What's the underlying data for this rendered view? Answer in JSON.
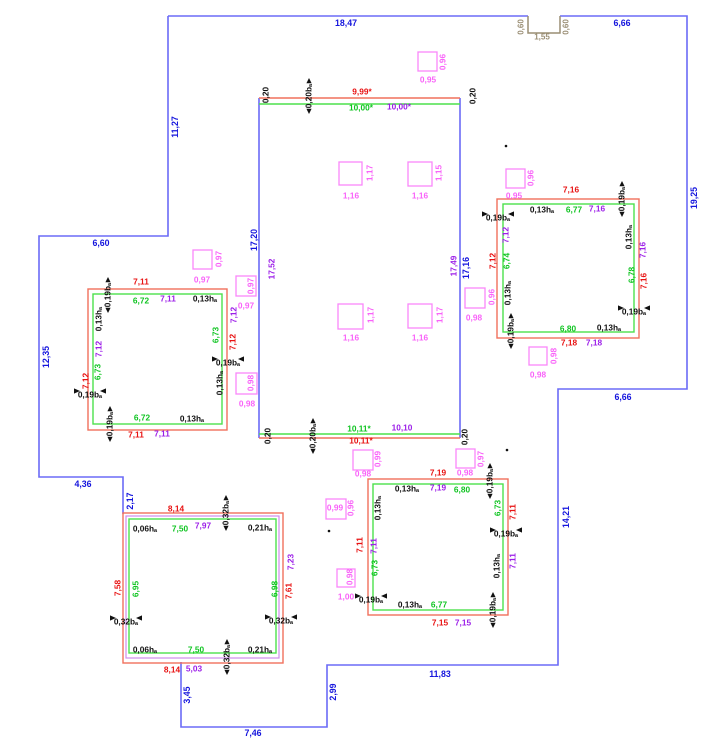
{
  "canvas": {
    "w": 724,
    "h": 745,
    "bg": "#ffffff"
  },
  "palette": {
    "blue": "#1515dd",
    "red": "#e81212",
    "green": "#0fc421",
    "purple": "#9c1fe8",
    "magenta": "#f963f9",
    "black": "#111111",
    "tan": "#9a8e74",
    "lblue": "#6b6bf7",
    "lred": "#f1705c",
    "lgreen": "#4ce04c",
    "lpurple": "#cf8cec",
    "lmagenta": "#fa87fa"
  },
  "polylines": [
    {
      "name": "building-outline-top",
      "c": "lblue",
      "sw": 1.6,
      "pts": [
        [
          168,
          16
        ],
        [
          528,
          16
        ]
      ]
    },
    {
      "name": "building-outline-right",
      "c": "lblue",
      "sw": 1.6,
      "pts": [
        [
          560,
          16
        ],
        [
          687,
          16
        ],
        [
          687,
          389
        ],
        [
          558,
          389
        ],
        [
          558,
          665
        ],
        [
          327,
          665
        ],
        [
          327,
          727
        ],
        [
          181,
          727
        ],
        [
          181,
          662
        ]
      ]
    },
    {
      "name": "building-outline-left",
      "c": "lblue",
      "sw": 1.6,
      "pts": [
        [
          123,
          514
        ],
        [
          123,
          477
        ],
        [
          39,
          477
        ],
        [
          39,
          236
        ],
        [
          168,
          236
        ],
        [
          168,
          16
        ]
      ]
    },
    {
      "name": "roof-notch",
      "c": "tan",
      "sw": 1.5,
      "pts": [
        [
          528,
          16
        ],
        [
          528,
          33
        ],
        [
          560,
          33
        ],
        [
          560,
          16
        ]
      ]
    },
    {
      "name": "hall-wall-left",
      "c": "lblue",
      "sw": 1.6,
      "pts": [
        [
          259,
          98
        ],
        [
          259,
          438
        ]
      ]
    },
    {
      "name": "hall-wall-right",
      "c": "lblue",
      "sw": 1.6,
      "pts": [
        [
          460,
          98
        ],
        [
          460,
          438
        ]
      ]
    },
    {
      "name": "hall-top-outer",
      "c": "lred",
      "sw": 1.4,
      "pts": [
        [
          259,
          98
        ],
        [
          460,
          98
        ]
      ]
    },
    {
      "name": "hall-top-inner",
      "c": "lgreen",
      "sw": 1.4,
      "pts": [
        [
          259,
          104
        ],
        [
          460,
          104
        ]
      ]
    },
    {
      "name": "hall-bottom-inner",
      "c": "lgreen",
      "sw": 1.4,
      "pts": [
        [
          259,
          434
        ],
        [
          460,
          434
        ]
      ]
    },
    {
      "name": "hall-bottom-outer",
      "c": "lred",
      "sw": 1.4,
      "pts": [
        [
          259,
          438
        ],
        [
          460,
          438
        ]
      ]
    }
  ],
  "rects": [
    {
      "name": "room-ne-outer",
      "c": "lred",
      "sw": 1.4,
      "x": 497,
      "y": 199,
      "w": 142,
      "h": 139
    },
    {
      "name": "room-ne-inner",
      "c": "lgreen",
      "sw": 1.4,
      "x": 503,
      "y": 204,
      "w": 131,
      "h": 128
    },
    {
      "name": "room-w-outer",
      "c": "lred",
      "sw": 1.4,
      "x": 88,
      "y": 289,
      "w": 139,
      "h": 141
    },
    {
      "name": "room-w-inner",
      "c": "lgreen",
      "sw": 1.4,
      "x": 93,
      "y": 294,
      "w": 129,
      "h": 130
    },
    {
      "name": "room-sw-outer",
      "c": "lred",
      "sw": 1.4,
      "x": 123,
      "y": 513,
      "w": 160,
      "h": 150
    },
    {
      "name": "room-sw-mid",
      "c": "lpurple",
      "sw": 1.2,
      "x": 126,
      "y": 516,
      "w": 153,
      "h": 142
    },
    {
      "name": "room-sw-inner",
      "c": "lgreen",
      "sw": 1.4,
      "x": 129,
      "y": 519,
      "w": 147,
      "h": 134
    },
    {
      "name": "room-s-outer",
      "c": "lred",
      "sw": 1.4,
      "x": 368,
      "y": 479,
      "w": 140,
      "h": 136
    },
    {
      "name": "room-s-inner",
      "c": "lgreen",
      "sw": 1.4,
      "x": 373,
      "y": 484,
      "w": 130,
      "h": 126
    }
  ],
  "windows": [
    {
      "x": 418,
      "y": 52,
      "s": 19
    },
    {
      "x": 339,
      "y": 162,
      "s": 23
    },
    {
      "x": 408,
      "y": 162,
      "s": 24
    },
    {
      "x": 338,
      "y": 304,
      "s": 25
    },
    {
      "x": 408,
      "y": 304,
      "s": 24
    },
    {
      "x": 193,
      "y": 250,
      "s": 19
    },
    {
      "x": 236,
      "y": 276,
      "s": 20
    },
    {
      "x": 236,
      "y": 373,
      "s": 21
    },
    {
      "x": 465,
      "y": 288,
      "s": 20
    },
    {
      "x": 506,
      "y": 169,
      "s": 19
    },
    {
      "x": 529,
      "y": 347,
      "s": 18
    },
    {
      "x": 353,
      "y": 450,
      "s": 20
    },
    {
      "x": 456,
      "y": 449,
      "s": 19
    },
    {
      "x": 326,
      "y": 499,
      "s": 20
    },
    {
      "x": 337,
      "y": 569,
      "s": 18
    }
  ],
  "dots": [
    [
      506,
      146
    ],
    [
      507,
      450
    ],
    [
      329,
      531
    ]
  ],
  "labels": [
    [
      "18,47",
      346,
      23,
      "blue",
      0,
      ""
    ],
    [
      "6,66",
      622,
      23,
      "blue",
      0,
      ""
    ],
    [
      "19,25",
      694,
      198,
      "blue",
      -90,
      ""
    ],
    [
      "6,66",
      623,
      397,
      "blue",
      0,
      ""
    ],
    [
      "14,21",
      566,
      517,
      "blue",
      -90,
      ""
    ],
    [
      "11,83",
      440,
      674,
      "blue",
      0,
      ""
    ],
    [
      "2,99",
      333,
      692,
      "blue",
      -90,
      ""
    ],
    [
      "7,46",
      253,
      733,
      "blue",
      0,
      ""
    ],
    [
      "3,45",
      187,
      695,
      "blue",
      -90,
      ""
    ],
    [
      "2,17",
      130,
      501,
      "blue",
      -90,
      ""
    ],
    [
      "4,36",
      83,
      484,
      "blue",
      0,
      ""
    ],
    [
      "12,35",
      46,
      357,
      "blue",
      -90,
      ""
    ],
    [
      "6,60",
      101,
      243,
      "blue",
      0,
      ""
    ],
    [
      "11,27",
      175,
      127,
      "blue",
      -90,
      ""
    ],
    [
      "17,20",
      254,
      240,
      "blue",
      -90,
      ""
    ],
    [
      "17,16",
      466,
      268,
      "blue",
      -90,
      ""
    ],
    [
      "0,60",
      521,
      27,
      "tan",
      -90,
      ""
    ],
    [
      "1,55",
      542,
      37,
      "tan",
      0,
      ""
    ],
    [
      "0,60",
      566,
      27,
      "tan",
      -90,
      ""
    ],
    [
      "9,99*",
      362,
      92,
      "red",
      0,
      ""
    ],
    [
      "10,11*",
      361,
      441,
      "red",
      0,
      ""
    ],
    [
      "7,16",
      571,
      190,
      "red",
      0,
      ""
    ],
    [
      "7,12",
      493,
      261,
      "red",
      -90,
      ""
    ],
    [
      "7,16",
      644,
      281,
      "red",
      -90,
      ""
    ],
    [
      "7,18",
      569,
      343,
      "red",
      0,
      ""
    ],
    [
      "7,11",
      141,
      282,
      "red",
      0,
      ""
    ],
    [
      "7,12",
      86,
      381,
      "red",
      -90,
      ""
    ],
    [
      "7,12",
      233,
      342,
      "red",
      -90,
      ""
    ],
    [
      "7,11",
      136,
      435,
      "red",
      0,
      ""
    ],
    [
      "8,14",
      176,
      509,
      "red",
      0,
      ""
    ],
    [
      "7,58",
      118,
      588,
      "red",
      -90,
      ""
    ],
    [
      "7,61",
      289,
      591,
      "red",
      -90,
      ""
    ],
    [
      "8,14",
      172,
      670,
      "red",
      0,
      ""
    ],
    [
      "7,19",
      438,
      473,
      "red",
      0,
      ""
    ],
    [
      "7,11",
      360,
      545,
      "red",
      -90,
      ""
    ],
    [
      "7,11",
      513,
      512,
      "red",
      -90,
      ""
    ],
    [
      "7,15",
      440,
      623,
      "red",
      0,
      ""
    ],
    [
      "10,00*",
      361,
      108,
      "green",
      0,
      ""
    ],
    [
      "10,11*",
      359,
      429,
      "green",
      0,
      ""
    ],
    [
      "6,77",
      574,
      210,
      "green",
      0,
      ""
    ],
    [
      "6,74",
      507,
      261,
      "green",
      -90,
      ""
    ],
    [
      "6,78",
      632,
      275,
      "green",
      -90,
      ""
    ],
    [
      "6,80",
      568,
      329,
      "green",
      0,
      ""
    ],
    [
      "6,72",
      141,
      301,
      "green",
      0,
      ""
    ],
    [
      "6,73",
      98,
      372,
      "green",
      -90,
      ""
    ],
    [
      "6,73",
      216,
      335,
      "green",
      -90,
      ""
    ],
    [
      "6,72",
      142,
      418,
      "green",
      0,
      ""
    ],
    [
      "7,50",
      180,
      529,
      "green",
      0,
      ""
    ],
    [
      "6,95",
      136,
      589,
      "green",
      -90,
      ""
    ],
    [
      "6,98",
      275,
      589,
      "green",
      -90,
      ""
    ],
    [
      "7,50",
      196,
      650,
      "green",
      0,
      ""
    ],
    [
      "6,80",
      462,
      490,
      "green",
      0,
      ""
    ],
    [
      "6,73",
      375,
      568,
      "green",
      -90,
      ""
    ],
    [
      "6,73",
      498,
      508,
      "green",
      -90,
      ""
    ],
    [
      "6,77",
      439,
      605,
      "green",
      0,
      ""
    ],
    [
      "10,00*",
      399,
      107,
      "purple",
      0,
      ""
    ],
    [
      "10,10",
      402,
      428,
      "purple",
      0,
      ""
    ],
    [
      "17,52",
      272,
      269,
      "purple",
      -90,
      ""
    ],
    [
      "17,49",
      454,
      266,
      "purple",
      -90,
      ""
    ],
    [
      "7,16",
      597,
      209,
      "purple",
      0,
      ""
    ],
    [
      "7,12",
      506,
      235,
      "purple",
      -90,
      ""
    ],
    [
      "7,16",
      643,
      250,
      "purple",
      -90,
      ""
    ],
    [
      "7,18",
      594,
      343,
      "purple",
      0,
      ""
    ],
    [
      "7,11",
      168,
      299,
      "purple",
      0,
      ""
    ],
    [
      "7,12",
      99,
      349,
      "purple",
      -90,
      ""
    ],
    [
      "7,12",
      234,
      315,
      "purple",
      -90,
      ""
    ],
    [
      "7,11",
      162,
      434,
      "purple",
      0,
      ""
    ],
    [
      "7,97",
      203,
      526,
      "purple",
      0,
      ""
    ],
    [
      "7,23",
      291,
      562,
      "purple",
      -90,
      ""
    ],
    [
      "5,03",
      194,
      669,
      "purple",
      0,
      ""
    ],
    [
      "7,19",
      438,
      488,
      "purple",
      0,
      ""
    ],
    [
      "7,11",
      374,
      546,
      "purple",
      -90,
      ""
    ],
    [
      "7,11",
      513,
      561,
      "purple",
      -90,
      ""
    ],
    [
      "7,15",
      463,
      623,
      "purple",
      0,
      ""
    ],
    [
      "0,20",
      266,
      95,
      "black",
      -90,
      ""
    ],
    [
      "0,20bₐ",
      309,
      96,
      "black",
      -90,
      "v"
    ],
    [
      "0,20",
      473,
      96,
      "black",
      -90,
      ""
    ],
    [
      "0,20",
      268,
      436,
      "black",
      -90,
      ""
    ],
    [
      "0,20bₐ",
      313,
      436,
      "black",
      -90,
      "v"
    ],
    [
      "0,20",
      465,
      437,
      "black",
      -90,
      ""
    ],
    [
      "0,13hₐ",
      542,
      210,
      "black",
      0,
      ""
    ],
    [
      "0,19bₐ",
      622,
      199,
      "black",
      -90,
      "v"
    ],
    [
      "0,19bₐ",
      498,
      218,
      "black",
      0,
      "h"
    ],
    [
      "0,13hₐ",
      508,
      293,
      "black",
      -90,
      ""
    ],
    [
      "0,13hₐ",
      629,
      237,
      "black",
      -90,
      ""
    ],
    [
      "0,19bₐ",
      634,
      312,
      "black",
      0,
      "h"
    ],
    [
      "0,19bₐ",
      511,
      331,
      "black",
      -90,
      "v"
    ],
    [
      "0,13hₐ",
      609,
      328,
      "black",
      0,
      ""
    ],
    [
      "0,19bₐ",
      108,
      295,
      "black",
      -90,
      "v"
    ],
    [
      "0,13hₐ",
      205,
      299,
      "black",
      0,
      ""
    ],
    [
      "0,13hₐ",
      99,
      319,
      "black",
      -90,
      ""
    ],
    [
      "0,19bₐ",
      90,
      395,
      "black",
      0,
      "h"
    ],
    [
      "0,19bₐ",
      228,
      363,
      "black",
      0,
      "h"
    ],
    [
      "0,13hₐ",
      220,
      383,
      "black",
      -90,
      ""
    ],
    [
      "0,13hₐ",
      192,
      419,
      "black",
      0,
      ""
    ],
    [
      "0,19bₐ",
      110,
      424,
      "black",
      -90,
      "v"
    ],
    [
      "0,32bₐ",
      226,
      513,
      "black",
      -90,
      "v"
    ],
    [
      "0,06hₐ",
      145,
      529,
      "black",
      0,
      ""
    ],
    [
      "0,21hₐ",
      260,
      528,
      "black",
      0,
      ""
    ],
    [
      "0,32bₐ",
      126,
      622,
      "black",
      0,
      "h"
    ],
    [
      "0,32bₐ",
      281,
      621,
      "black",
      0,
      "h"
    ],
    [
      "0,06hₐ",
      145,
      650,
      "black",
      0,
      ""
    ],
    [
      "0,21hₐ",
      260,
      650,
      "black",
      0,
      ""
    ],
    [
      "0,32bₐ",
      227,
      657,
      "black",
      -90,
      "v"
    ],
    [
      "0,13hₐ",
      407,
      489,
      "black",
      0,
      ""
    ],
    [
      "0,19bₐ",
      490,
      481,
      "black",
      -90,
      "v"
    ],
    [
      "0,13hₐ",
      378,
      508,
      "black",
      -90,
      ""
    ],
    [
      "0,19bₐ",
      371,
      600,
      "black",
      0,
      "h"
    ],
    [
      "0,19bₐ",
      506,
      534,
      "black",
      0,
      "h"
    ],
    [
      "0,13hₐ",
      497,
      566,
      "black",
      -90,
      ""
    ],
    [
      "0,13hₐ",
      410,
      605,
      "black",
      0,
      ""
    ],
    [
      "0,19bₐ",
      493,
      610,
      "black",
      -90,
      "v"
    ],
    [
      "0,95",
      428,
      80,
      "magenta",
      0,
      ""
    ],
    [
      "0,96",
      443,
      62,
      "magenta",
      -90,
      ""
    ],
    [
      "1,16",
      351,
      196,
      "magenta",
      0,
      ""
    ],
    [
      "1,17",
      370,
      173,
      "magenta",
      -90,
      ""
    ],
    [
      "1,16",
      420,
      196,
      "magenta",
      0,
      ""
    ],
    [
      "1,15",
      439,
      173,
      "magenta",
      -90,
      ""
    ],
    [
      "1,16",
      351,
      338,
      "magenta",
      0,
      ""
    ],
    [
      "1,17",
      371,
      315,
      "magenta",
      -90,
      ""
    ],
    [
      "1,16",
      420,
      338,
      "magenta",
      0,
      ""
    ],
    [
      "1,17",
      440,
      315,
      "magenta",
      -90,
      ""
    ],
    [
      "0,97",
      202,
      280,
      "magenta",
      0,
      ""
    ],
    [
      "0,97",
      219,
      259,
      "magenta",
      -90,
      ""
    ],
    [
      "0,97",
      246,
      306,
      "magenta",
      0,
      ""
    ],
    [
      "0,97",
      251,
      286,
      "magenta",
      -90,
      ""
    ],
    [
      "0,98",
      247,
      404,
      "magenta",
      0,
      ""
    ],
    [
      "0,98",
      251,
      383,
      "magenta",
      -90,
      ""
    ],
    [
      "0,98",
      474,
      318,
      "magenta",
      0,
      ""
    ],
    [
      "0,96",
      492,
      297,
      "magenta",
      -90,
      ""
    ],
    [
      "0,95",
      514,
      196,
      "magenta",
      0,
      ""
    ],
    [
      "0,96",
      531,
      178,
      "magenta",
      -90,
      ""
    ],
    [
      "0,98",
      538,
      375,
      "magenta",
      0,
      ""
    ],
    [
      "0,98",
      554,
      356,
      "magenta",
      -90,
      ""
    ],
    [
      "0,98",
      363,
      474,
      "magenta",
      0,
      ""
    ],
    [
      "0,99",
      378,
      459,
      "magenta",
      -90,
      ""
    ],
    [
      "0,98",
      465,
      473,
      "magenta",
      0,
      ""
    ],
    [
      "0,97",
      481,
      459,
      "magenta",
      -90,
      ""
    ],
    [
      "0,99",
      335,
      508,
      "magenta",
      0,
      ""
    ],
    [
      "0,96",
      351,
      508,
      "magenta",
      -90,
      ""
    ],
    [
      "1,00",
      346,
      597,
      "magenta",
      0,
      ""
    ],
    [
      "0,98",
      350,
      577,
      "magenta",
      -90,
      ""
    ]
  ]
}
